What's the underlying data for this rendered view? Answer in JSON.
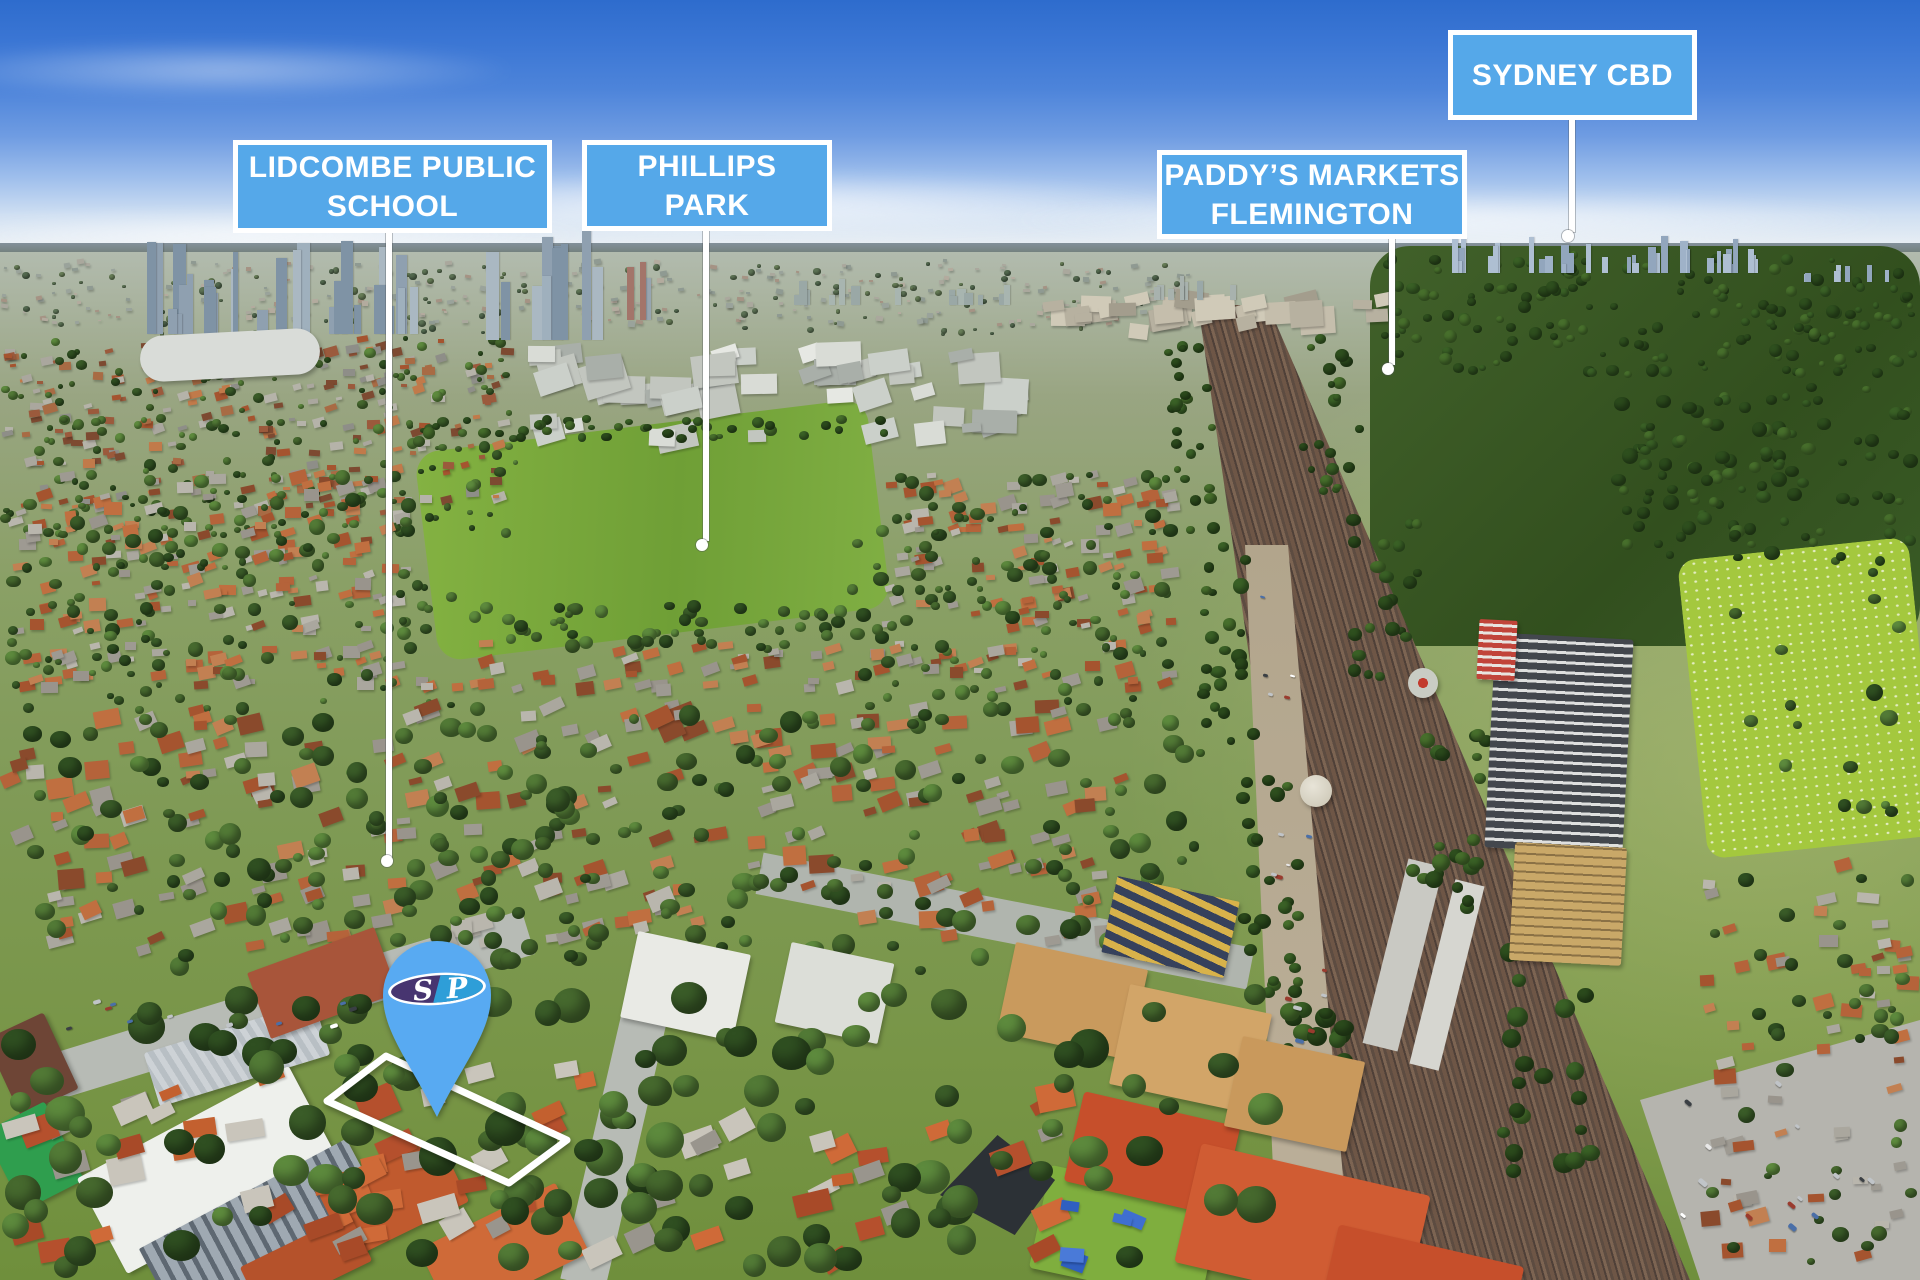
{
  "callouts": [
    {
      "label": "LIDCOMBE PUBLIC SCHOOL",
      "line1": "LIDCOMBE PUBLIC",
      "line2": "SCHOOL"
    },
    {
      "label": "PHILLIPS PARK",
      "line1": "PHILLIPS",
      "line2": "PARK"
    },
    {
      "label": "PADDY’S MARKETS FLEMINGTON",
      "line1": "PADDY’S MARKETS",
      "line2": "FLEMINGTON"
    },
    {
      "label": "SYDNEY CBD",
      "line1": "SYDNEY CBD"
    }
  ],
  "marker": {
    "logo_letter_left": "S",
    "logo_letter_right": "P"
  },
  "colors": {
    "callout_fill": "#55a8e9",
    "callout_border": "#ffffff",
    "callout_text": "#ffffff",
    "leader": "#ffffff",
    "boundary": "#ffffff",
    "marker_fill": "#58aaf2",
    "logo_left": "#46356f",
    "logo_right": "#2e9ed8",
    "logo_text": "#ffffff"
  }
}
